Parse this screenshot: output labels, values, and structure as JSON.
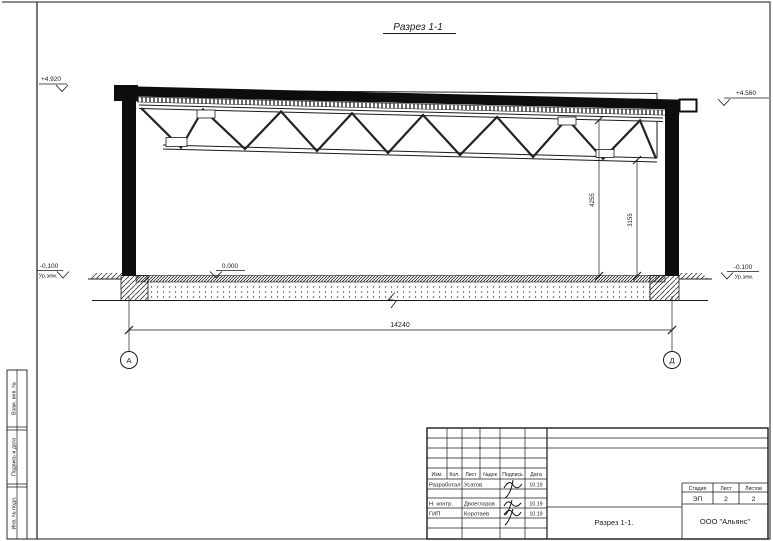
{
  "colors": {
    "ink": "#1a1a1a",
    "paper": "#ffffff"
  },
  "drawing": {
    "title": "Разрез 1-1",
    "grid_axes": [
      "А",
      "Д"
    ],
    "elevations": {
      "roof_left": "+4.920",
      "roof_right": "+4.560",
      "floor": "0.000",
      "ground": "-0.100",
      "ground_label": "Ур.зем."
    },
    "dimensions": {
      "span": "14240",
      "truss_height_left": "4255",
      "truss_height_right": "3155"
    }
  },
  "titleblock": {
    "columns": [
      "Изм.",
      "Кол.",
      "Лист",
      "№док",
      "Подпись",
      "Дата"
    ],
    "signature_rows": [
      {
        "role": "Разработал",
        "name": "Усатов",
        "date": "10.19"
      },
      {
        "role": "Н. контр.",
        "name": "Двоеглазов",
        "date": "10.19"
      },
      {
        "role": "ГИП",
        "name": "Коротаев",
        "date": "10.19"
      }
    ],
    "stage_columns": [
      "Стадия",
      "Лист",
      "Листов"
    ],
    "stage_values": [
      "ЭП",
      "2",
      "2"
    ],
    "doc_title": "Разрез 1-1.",
    "company": "ООО \"Альянс\""
  },
  "sidebar": {
    "labels": [
      "Взам. инв. №",
      "Подпись и дата",
      "Инв. № подл."
    ]
  }
}
